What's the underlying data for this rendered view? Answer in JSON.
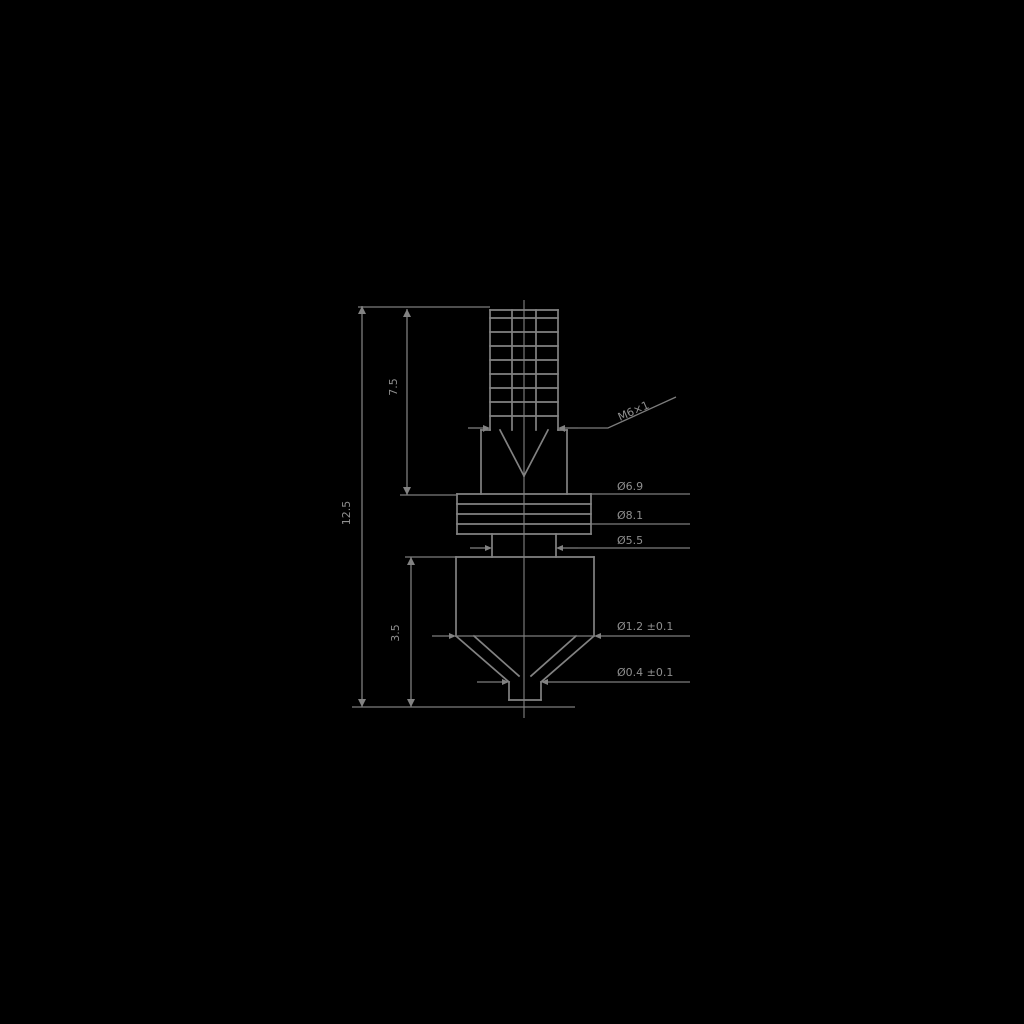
{
  "page": {
    "background_color": "#000000"
  },
  "drawing": {
    "type": "technical-drawing",
    "subject": "threaded nozzle cross-section with dimension callouts",
    "line_color": "#828282",
    "text_color": "#8f8f8f",
    "labels": {
      "overall_height": "12.5",
      "upper_section_height": "7.5",
      "lower_section_height": "3.5",
      "thread_callout": "M6×1",
      "flange_top_diameter": "Ø6.9",
      "flange_bottom_diameter": "Ø8.1",
      "neck_diameter": "Ø5.5",
      "cone_base_diameter": "Ø1.2 ±0.1",
      "tip_orifice_diameter": "Ø0.4 ±0.1"
    }
  }
}
